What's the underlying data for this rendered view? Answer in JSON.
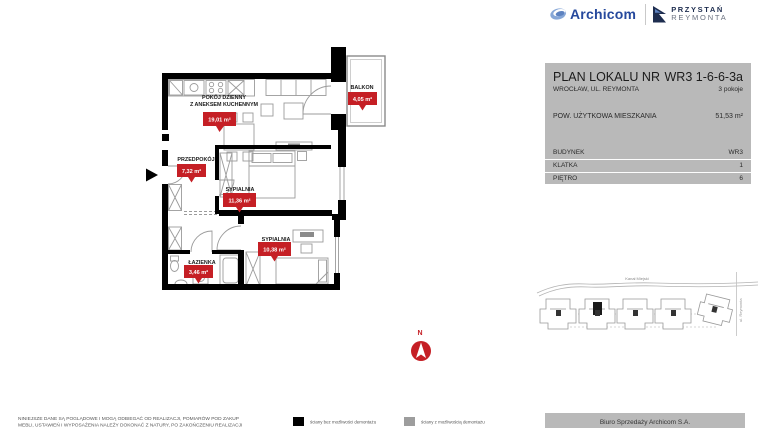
{
  "header": {
    "brand": "Archicom",
    "project_line1": "PRZYSTAŃ",
    "project_line2": "REYMONTA"
  },
  "info_panel": {
    "title": "PLAN LOKALU NR",
    "unit_number": "WR3 1-6-6-3a",
    "address": "WROCŁAW, UL. REYMONTA",
    "rooms_count": "3 pokoje",
    "area_label": "POW. UŻYTKOWA MIESZKANIA",
    "area_value": "51,53 m²",
    "details": [
      {
        "label": "BUDYNEK",
        "value": "WR3"
      },
      {
        "label": "KLATKA",
        "value": "1"
      },
      {
        "label": "PIĘTRO",
        "value": "6"
      }
    ]
  },
  "floor_plan": {
    "compass_label": "N",
    "rooms": [
      {
        "name": "POKÓJ DZIENNY",
        "name2": "Z ANEKSEM KUCHENNYM",
        "area": "19,01 m²"
      },
      {
        "name": "BALKON",
        "area": "4,05 m²"
      },
      {
        "name": "PRZEDPOKÓJ",
        "area": "7,32 m²"
      },
      {
        "name": "SYPIALNIA",
        "area": "11,36 m²"
      },
      {
        "name": "SYPIALNIA",
        "area": "10,38 m²"
      },
      {
        "name": "ŁAZIENKA",
        "area": "3,46 m²"
      }
    ]
  },
  "site_plan": {
    "canal_label": "Kanał Miejski",
    "street_label": "ul. Reymonta"
  },
  "legend": [
    {
      "color": "#000000",
      "label": "ściany bez możliwości demontażu"
    },
    {
      "color": "#9d9d9d",
      "label": "ściany z możliwością demontażu"
    }
  ],
  "footer": {
    "disclaimer_line1": "NINIEJSZE DANE SĄ POGLĄDOWE I MOGĄ ODBIEGAĆ OD REALIZACJI, POMIARÓW POD ZAKUP",
    "disclaimer_line2": "MEBLI, USTAWIEŃ I WYPOSAŻENIA NALEŻY DOKONAĆ Z NATURY, PO ZAKOŃCZENIU REALIZACJI",
    "sales_office": "Biuro Sprzedaży Archicom S.A."
  },
  "colors": {
    "accent_red": "#c51f25",
    "panel_gray": "#b9b9b9",
    "brand_blue": "#26499d",
    "navy": "#1e2d4f"
  }
}
